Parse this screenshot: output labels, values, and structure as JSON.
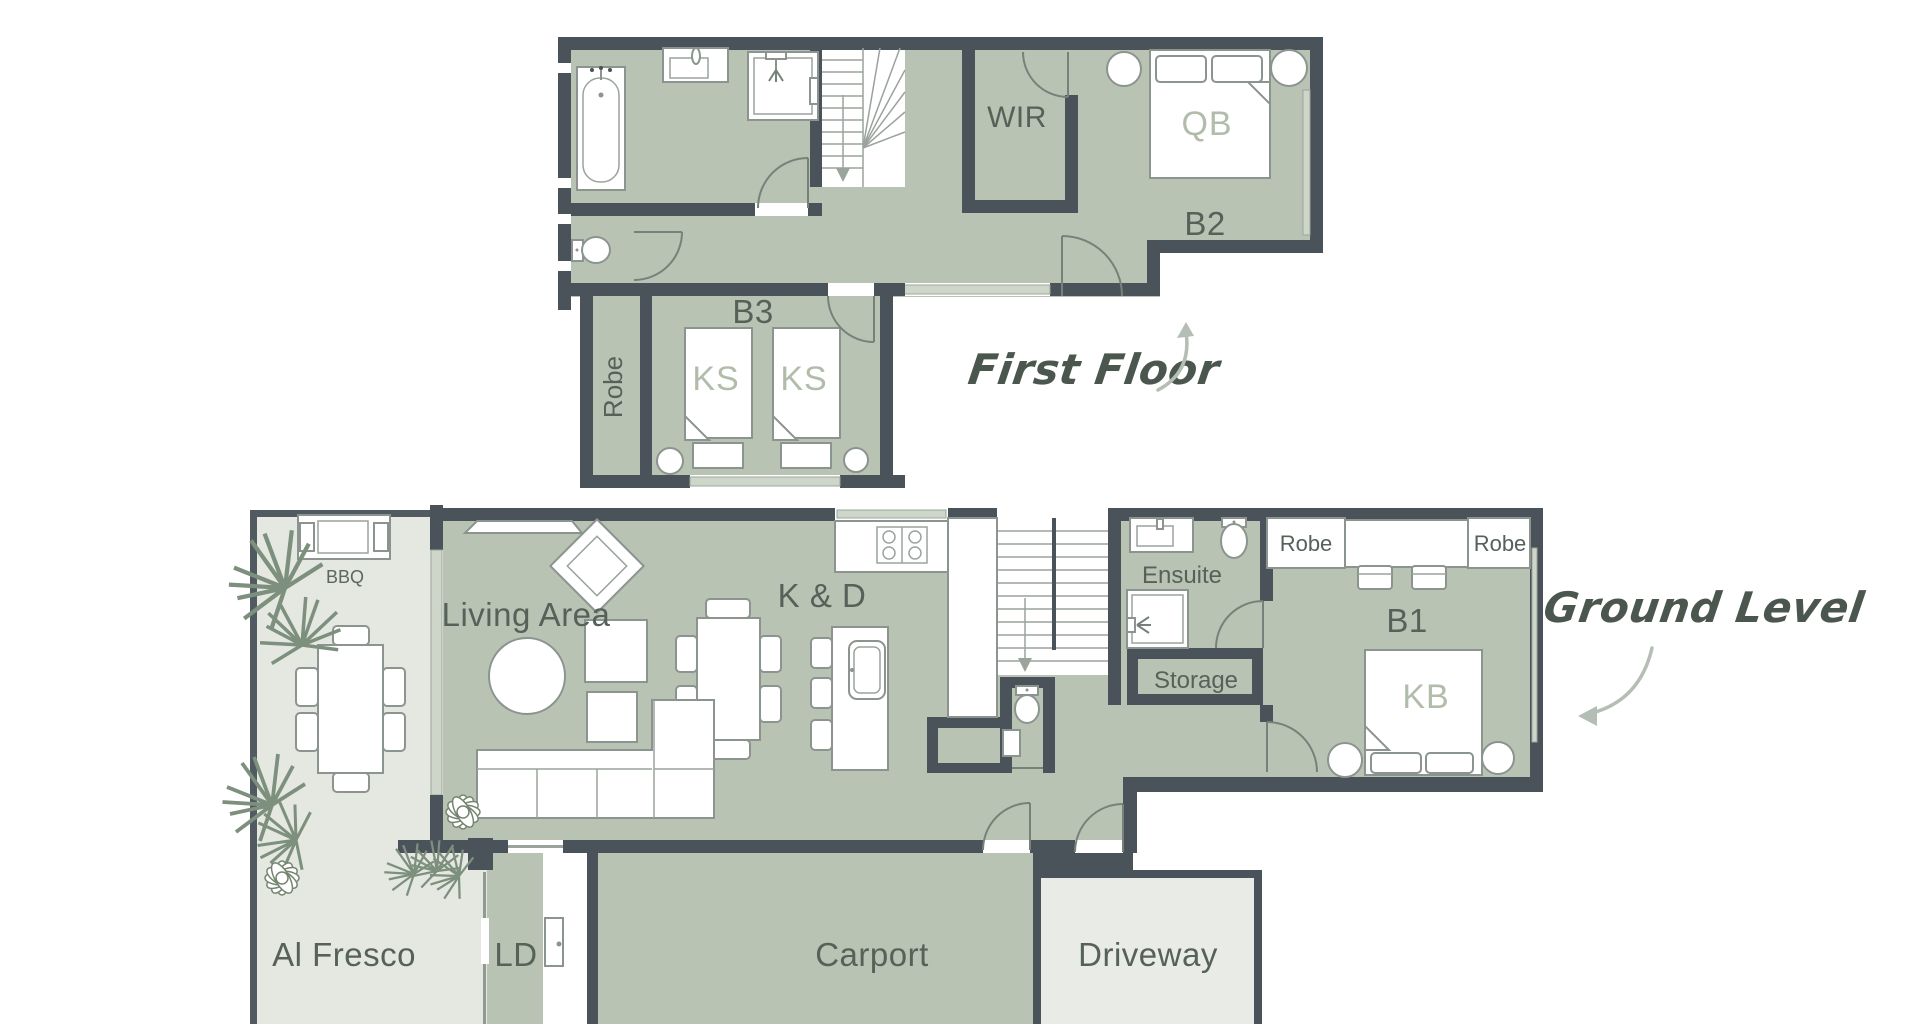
{
  "palette": {
    "wall": "#4a525a",
    "room_fill": "#b9c3b3",
    "outdoor_fill": "#e4e8e0",
    "driveway_fill": "#e9ece6",
    "window_fill": "#ced6ca",
    "furniture_stroke": "#8b948e",
    "label_dark": "#566159",
    "label_light": "#b2bcab",
    "script_color": "#4b564f",
    "arrow_color": "#b5beb4"
  },
  "first_floor": {
    "annotation": {
      "label": "First Floor"
    },
    "rooms": {
      "wir": {
        "label": "WIR"
      },
      "b2": {
        "label": "B2"
      },
      "b3": {
        "label": "B3"
      },
      "robe": {
        "label": "Robe"
      }
    },
    "furniture_labels": {
      "qb": {
        "label": "QB"
      },
      "ks_left": {
        "label": "KS"
      },
      "ks_right": {
        "label": "KS"
      }
    }
  },
  "ground_floor": {
    "annotation": {
      "label": "Ground Level"
    },
    "rooms": {
      "living": {
        "label": "Living Area"
      },
      "kitchen_dining": {
        "label": "K & D"
      },
      "ensuite": {
        "label": "Ensuite"
      },
      "storage": {
        "label": "Storage"
      },
      "robe_left": {
        "label": "Robe"
      },
      "robe_right": {
        "label": "Robe"
      },
      "b1": {
        "label": "B1"
      },
      "bbq": {
        "label": "BBQ"
      },
      "al_fresco": {
        "label": "Al Fresco"
      },
      "laundry": {
        "label": "LD"
      },
      "carport": {
        "label": "Carport"
      },
      "driveway": {
        "label": "Driveway"
      }
    },
    "furniture_labels": {
      "kb": {
        "label": "KB"
      }
    }
  }
}
